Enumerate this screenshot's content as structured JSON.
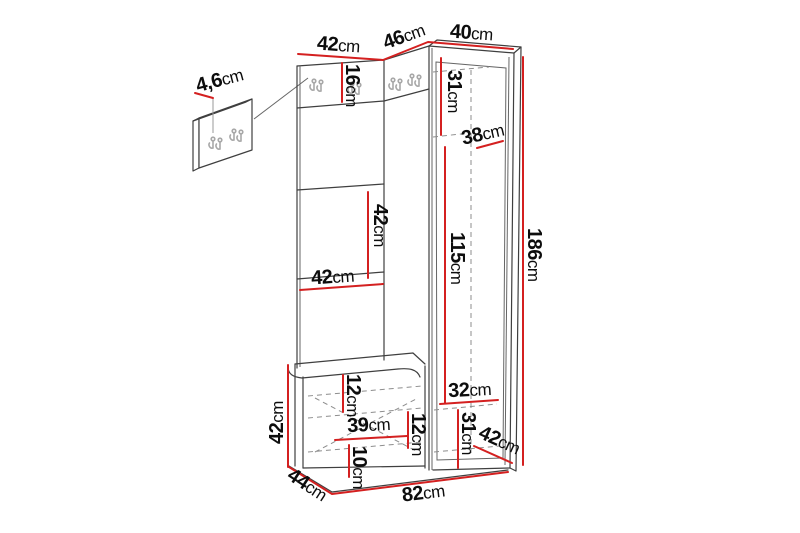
{
  "colors": {
    "dimension_red": "#d42020",
    "structure_line": "#3f3f3f",
    "hook_gray": "#a8a8a8",
    "background": "#ffffff"
  },
  "diagram": {
    "dimensions": {
      "top_left_width": {
        "value": "42",
        "unit": "cm"
      },
      "top_corner_width": {
        "value": "46",
        "unit": "cm"
      },
      "top_right_width": {
        "value": "40",
        "unit": "cm"
      },
      "hook_panel_thickness": {
        "value": "4,6",
        "unit": "cm"
      },
      "hook_strip_height": {
        "value": "16",
        "unit": "cm"
      },
      "cabinet_upper_height": {
        "value": "31",
        "unit": "cm"
      },
      "cabinet_top_depth": {
        "value": "38",
        "unit": "cm"
      },
      "panel_section_height": {
        "value": "42",
        "unit": "cm"
      },
      "panel_section_width": {
        "value": "42",
        "unit": "cm"
      },
      "cabinet_interior_height": {
        "value": "115",
        "unit": "cm"
      },
      "total_height": {
        "value": "186",
        "unit": "cm"
      },
      "bench_height": {
        "value": "42",
        "unit": "cm"
      },
      "seat_thickness": {
        "value": "12",
        "unit": "cm"
      },
      "bench_interior_width": {
        "value": "39",
        "unit": "cm"
      },
      "bench_interior_height": {
        "value": "12",
        "unit": "cm"
      },
      "bench_plinth_height": {
        "value": "10",
        "unit": "cm"
      },
      "cabinet_bottom_width": {
        "value": "32",
        "unit": "cm"
      },
      "cabinet_bottom_height": {
        "value": "31",
        "unit": "cm"
      },
      "cabinet_bottom_depth": {
        "value": "42",
        "unit": "cm"
      },
      "bench_depth": {
        "value": "44",
        "unit": "cm"
      },
      "total_width": {
        "value": "82",
        "unit": "cm"
      }
    }
  }
}
